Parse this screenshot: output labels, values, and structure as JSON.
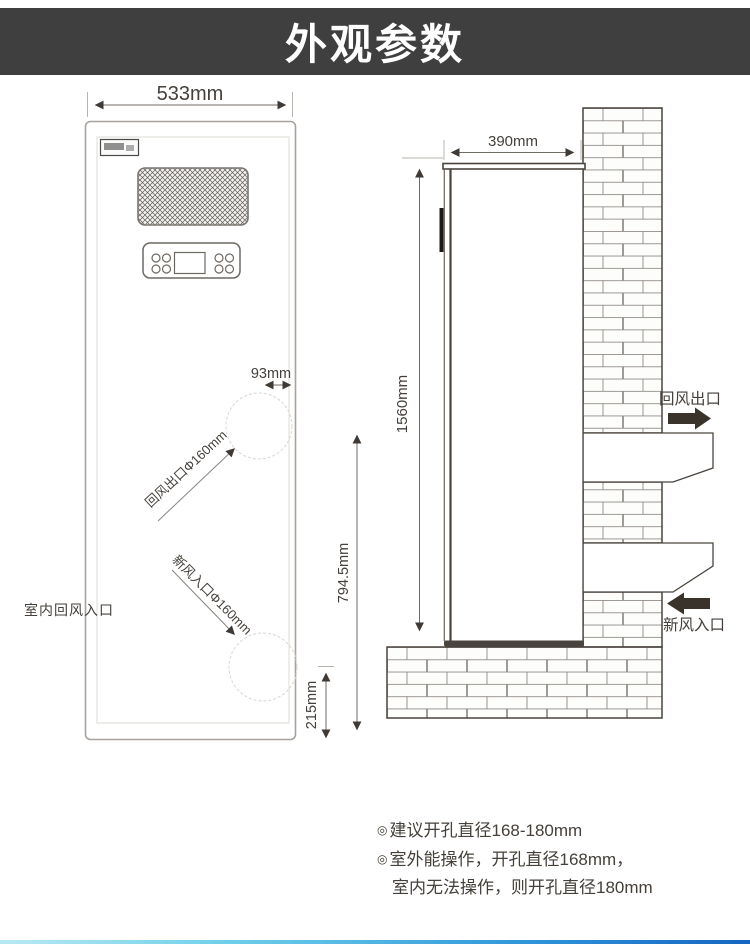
{
  "header": {
    "title": "外观参数"
  },
  "front_view": {
    "width_dim": "533mm",
    "gap_dim": "93mm",
    "return_outlet_label": "回风出口Φ160mm",
    "fresh_inlet_label": "新风入口Φ160mm",
    "indoor_return_inlet_label": "室内回风入口",
    "lower_height_dim": "794.5mm",
    "base_height_dim": "215mm"
  },
  "side_view": {
    "depth_dim": "390mm",
    "height_dim": "1560mm",
    "return_outlet_label": "回风出口",
    "fresh_inlet_label": "新风入口"
  },
  "notes": {
    "bullet": "◎",
    "line1": "建议开孔直径168-180mm",
    "line2": "室外能操作，开孔直径168mm，",
    "line3": "室内无法操作，则开孔直径180mm"
  },
  "colors": {
    "header_bg": "#3f3f3f",
    "dark_line": "#4a443e",
    "light_line": "#a8a29c",
    "text": "#45403a",
    "accent_left": "#b8e9f2",
    "accent_right": "#1565c0"
  }
}
